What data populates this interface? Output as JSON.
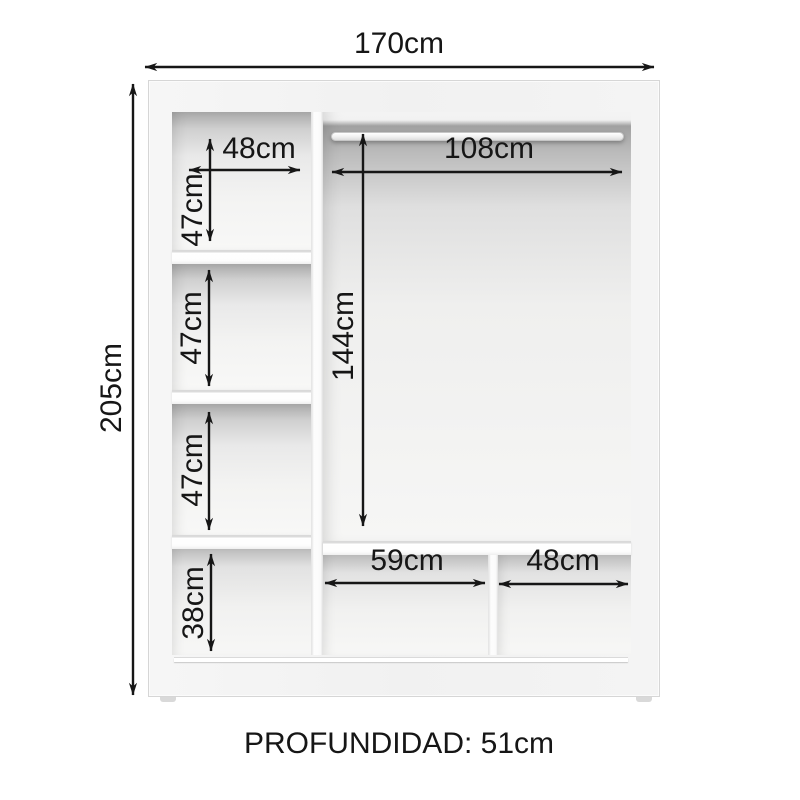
{
  "diagram": {
    "kind": "wardrobe-dimension-diagram",
    "overall": {
      "width": "170cm",
      "height": "205cm"
    },
    "left_column": {
      "shelf_width": "48cm",
      "compartment_heights": [
        "47cm",
        "47cm",
        "47cm",
        "38cm"
      ]
    },
    "right_section": {
      "rod_span_width": "108cm",
      "hanging_height": "144cm",
      "bottom_compartment_widths": [
        "59cm",
        "48cm"
      ]
    },
    "footer": {
      "depth_label": "PROFUNDIDAD: 51cm"
    },
    "colors": {
      "line": "#161616",
      "furniture_white": "#f5f5f5",
      "interior_shadow": "#a8a8a8",
      "background": "#ffffff"
    }
  }
}
